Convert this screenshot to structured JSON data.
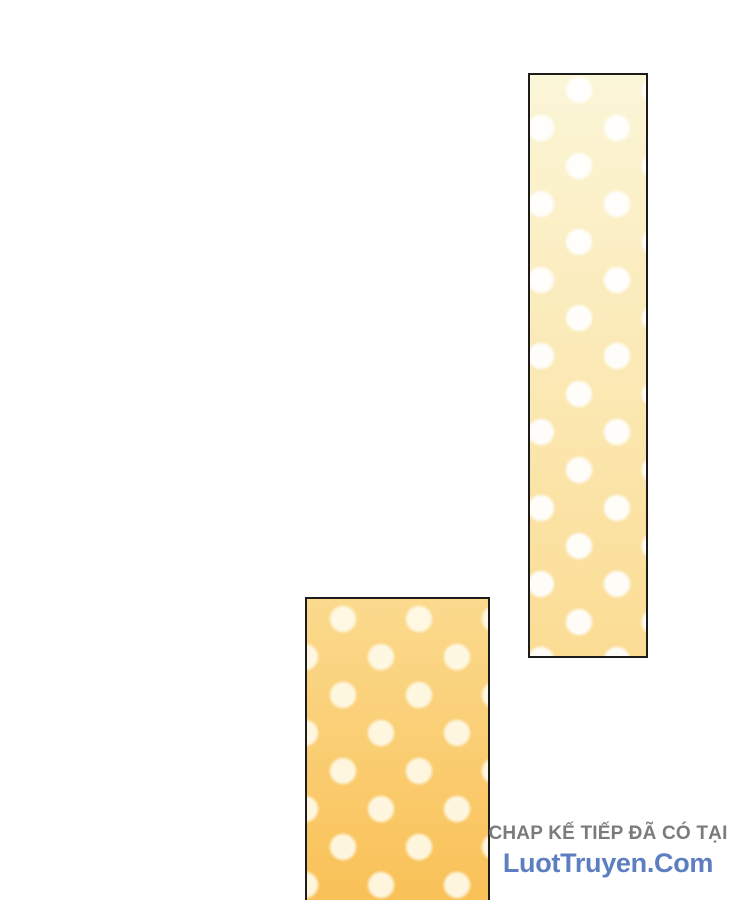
{
  "page": {
    "background_color": "#ffffff"
  },
  "panels": {
    "tall_right": {
      "border_color": "#1c1c1c",
      "bg_top": "#fbf6d8",
      "bg_bottom": "#fbdc93",
      "dot_color": "rgba(255,255,255,0.92)"
    },
    "bottom_left": {
      "border_color": "#1c1c1c",
      "bg_top": "#fbda8e",
      "bg_bottom": "#f9c157",
      "dot_color": "rgba(255,252,238,0.88)"
    }
  },
  "watermark": {
    "line1": "CHAP KẾ TIẾP ĐÃ CÓ TẠI",
    "line1_color": "#7b7b7b",
    "line2": "LuotTruyen.Com",
    "line2_color": "#5e7ec2"
  }
}
